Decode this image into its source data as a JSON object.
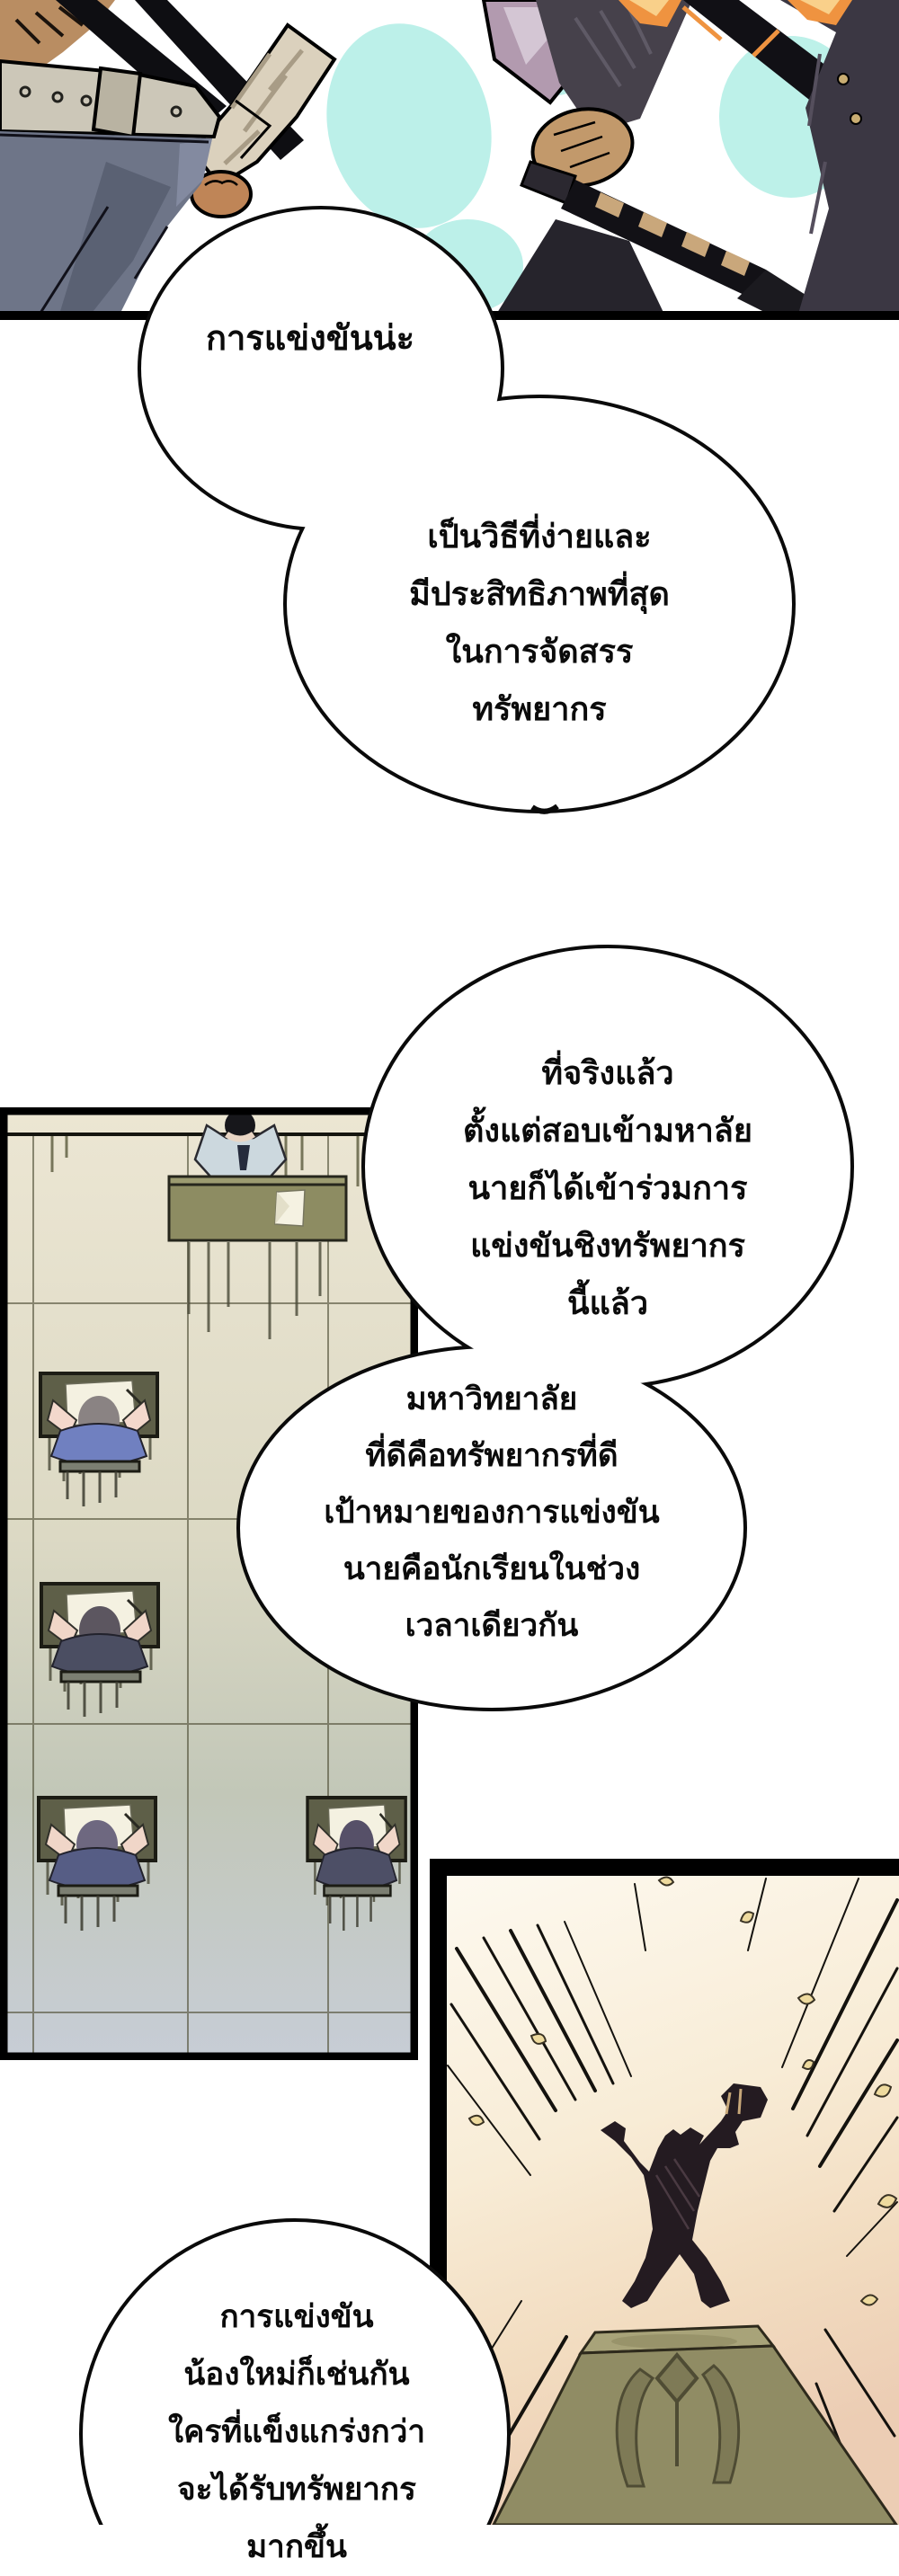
{
  "page": {
    "kind": "manhwa comic page",
    "background": "#ffffff"
  },
  "speech_bubbles": {
    "bubble1": {
      "text": "การแข่งขันน่ะ"
    },
    "bubble2": {
      "text": "เป็นวิธีที่ง่ายและ\nมีประสิทธิภาพที่สุด\nในการจัดสรร\nทรัพยากร"
    },
    "bubble3": {
      "text": "ที่จริงแล้ว\nตั้งแต่สอบเข้ามหาลัย\nนายก็ได้เข้าร่วมการ\nแข่งขันชิงทรัพยากร\nนี้แล้ว"
    },
    "bubble4": {
      "text": "มหาวิทยาลัย\nที่ดีคือทรัพยากรที่ดี\nเป้าหมายของการแข่งขัน\nนายคือนักเรียนในช่วง\nเวลาเดียวกัน"
    },
    "bubble5": {
      "text": "การแข่งขัน\nน้องใหม่ก็เช่นกัน\nใครที่แข็งแกร่งกว่า\nจะได้รับทรัพยากร\nมากขึ้น"
    }
  },
  "colors": {
    "panel_border": "#000000",
    "bubble_fill": "#ffffff",
    "bubble_stroke": "#0a0a0a",
    "sky_cyan": "#b9f0e8",
    "skin_tan": "#b98d62",
    "bandage": "#dbd1bd",
    "belt_grey": "#ccc7b8",
    "pants_blue_grey": "#6e7588",
    "purple_blade": "#b29aaf",
    "dark_jacket": "#46414b",
    "spark_orange": "#ef9340",
    "classroom_floor_top": "#ece6d3",
    "classroom_floor_bottom": "#c7cdd6",
    "desk_olive": "#8d8c62",
    "student_desk": "#5e5f48",
    "teacher_shirt": "#ccd8de",
    "student_blue_shirt": "#7080c0",
    "podium_bg_top": "#fdf9ef",
    "podium_bg_bottom": "#eccdb4",
    "pedestal_olive": "#908c64",
    "statue_silhouette": "#241b21",
    "confetti_gold": "#eeda9e"
  }
}
